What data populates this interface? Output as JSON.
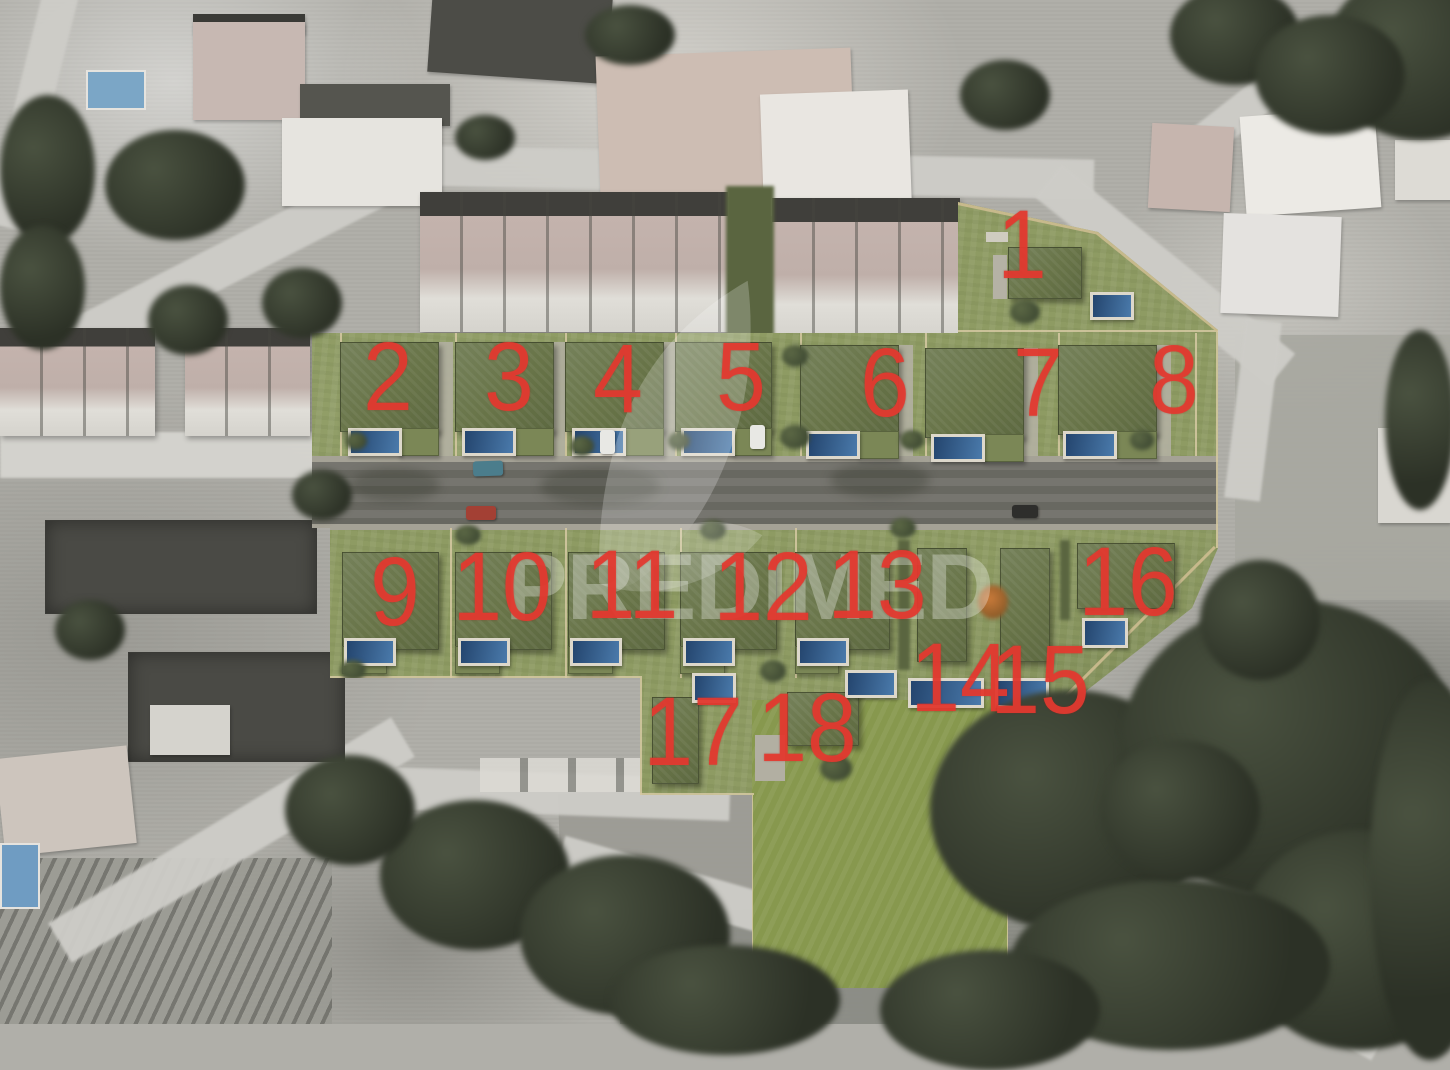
{
  "scene": {
    "type": "aerial-site-plan",
    "description": "Satellite photo with rendered housing development overlay of 18 numbered lots, each with green roof villa and pool, along a central street",
    "lot_count": "18"
  },
  "watermark": {
    "text": "PREDIMED",
    "logo": "leaf-watermark"
  },
  "colors": {
    "lot_number_red": "#e43a30",
    "site_grass_green": "#8e9b63",
    "roof_green": "#6b7748",
    "pool_blue": "#3f6fa3",
    "road_gray": "#6f6e67",
    "watermark_white": "#ffffff"
  },
  "lots": [
    {
      "label": "1"
    },
    {
      "label": "2"
    },
    {
      "label": "3"
    },
    {
      "label": "4"
    },
    {
      "label": "5"
    },
    {
      "label": "6"
    },
    {
      "label": "7"
    },
    {
      "label": "8"
    },
    {
      "label": "9"
    },
    {
      "label": "10"
    },
    {
      "label": "11"
    },
    {
      "label": "12"
    },
    {
      "label": "13"
    },
    {
      "label": "14"
    },
    {
      "label": "15"
    },
    {
      "label": "16"
    },
    {
      "label": "17"
    },
    {
      "label": "18"
    }
  ]
}
